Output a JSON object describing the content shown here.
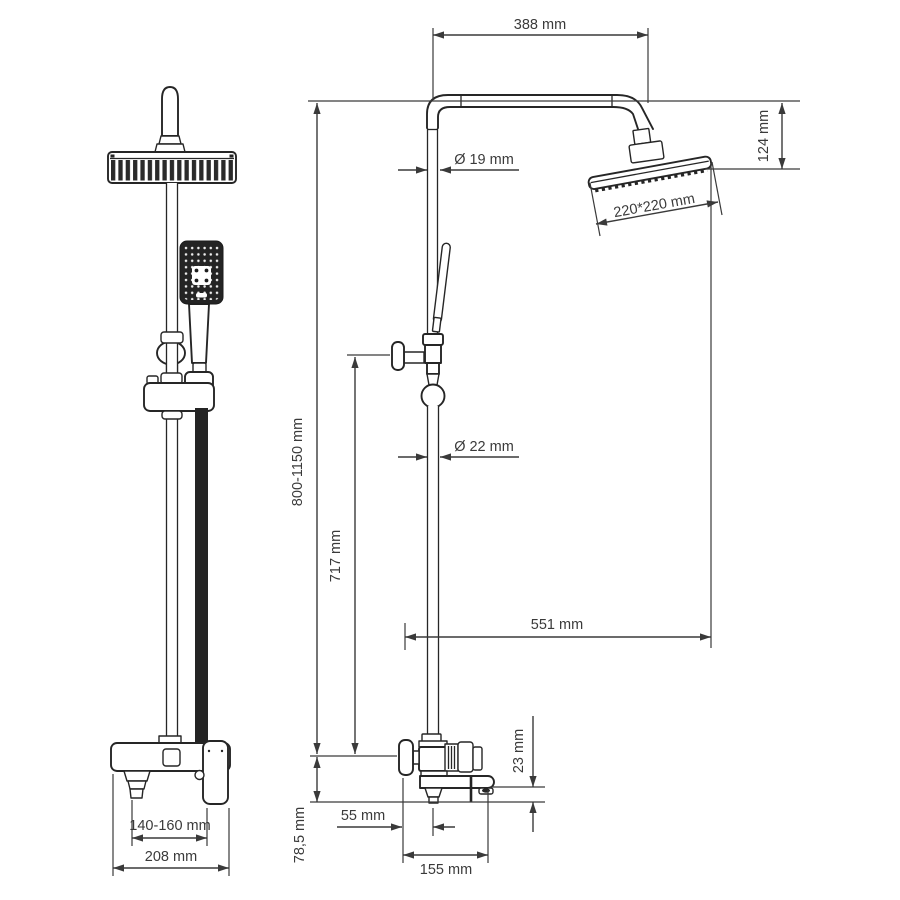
{
  "drawing": {
    "type": "shower-system-technical-drawing",
    "colors": {
      "background": "#ffffff",
      "drawing_line": "#262626",
      "dimension_line": "#3a3a3a"
    }
  },
  "dimensions": {
    "arm_reach": "388 mm",
    "head_drop": "124 mm",
    "upper_pipe_diameter": "Ø 19 mm",
    "head_size": "220*220 mm",
    "height_range": "800-1150 mm",
    "lower_pipe_diameter": "Ø 22 mm",
    "bar_height": "717 mm",
    "wall_to_head": "551 mm",
    "spout_drop": "23 mm",
    "wall_to_pipe_center": "55 mm",
    "center_to_spout_bottom": "78,5 mm",
    "spout_reach": "155 mm",
    "spout_to_handle": "140-160 mm",
    "body_width": "208 mm"
  }
}
